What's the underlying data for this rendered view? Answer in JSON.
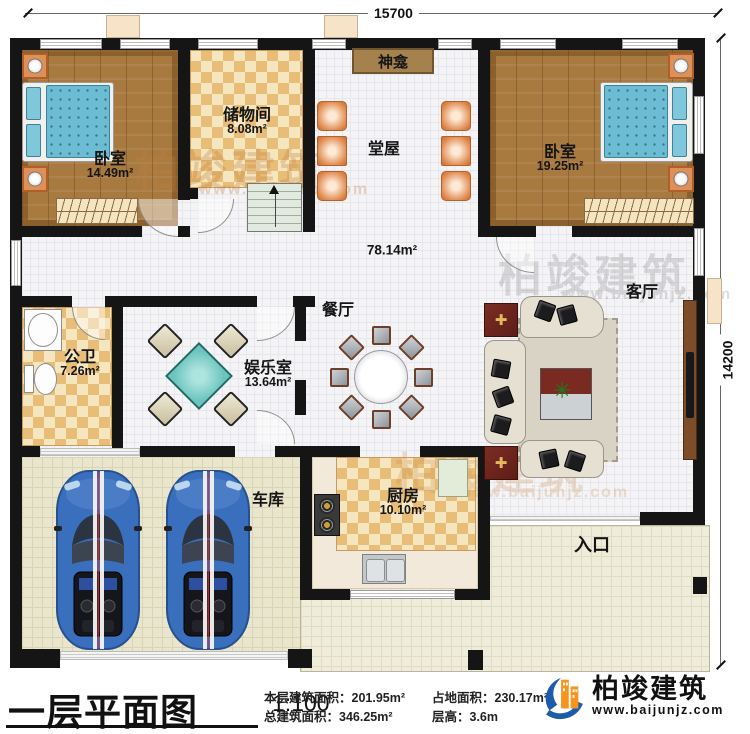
{
  "dims": {
    "top": "15700",
    "right": "14200"
  },
  "rooms": {
    "bedroom1": {
      "name": "卧室",
      "area": "14.49m²"
    },
    "storage": {
      "name": "储物间",
      "area": "8.08m²"
    },
    "shrine": {
      "name": "神龛"
    },
    "tangwu": {
      "name": "堂屋"
    },
    "bedroom2": {
      "name": "卧室",
      "area": "19.25m²"
    },
    "hall": {
      "area": "78.14m²"
    },
    "bathroom": {
      "name": "公卫",
      "area": "7.26m²"
    },
    "entertainment": {
      "name": "娱乐室",
      "area": "13.64m²"
    },
    "dining": {
      "name": "餐厅"
    },
    "living": {
      "name": "客厅"
    },
    "garage": {
      "name": "车库"
    },
    "kitchen": {
      "name": "厨房",
      "area": "10.10m²"
    },
    "entrance": {
      "name": "入口"
    }
  },
  "title_block": {
    "title": "一层平面图",
    "scale": "1:100",
    "stats": [
      "本层建筑面积：201.95m²",
      "占地面积：230.17m²",
      "总建筑面积：346.25m²",
      "层高：3.6m"
    ]
  },
  "brand": {
    "name": "柏竣建筑",
    "url": "www.baijunjz.com"
  },
  "colors": {
    "wall": "#151515",
    "wood": "#a87a40",
    "checker": "#e7bd78",
    "mattress": "#6cbcd4",
    "car": "#3a6fbd",
    "brand_blue": "#1d5ca8",
    "brand_orange": "#f7941d"
  }
}
